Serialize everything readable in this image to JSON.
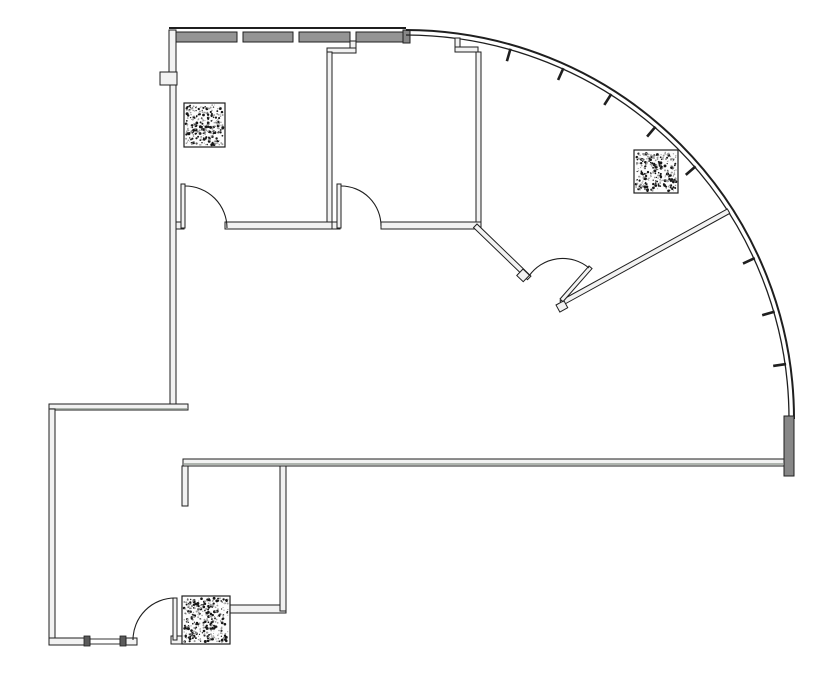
{
  "canvas": {
    "width": 835,
    "height": 678,
    "background": "#ffffff"
  },
  "colors": {
    "line": "#1f1f1f",
    "wall_fill": "#f2f2f2",
    "band_fill": "#949494",
    "heavy_fill": "#878787",
    "gray_line": "#98a098",
    "mullion": "#5a5a5a",
    "paper": "#ffffff"
  },
  "curved_wall": {
    "cx": 405,
    "cy": 419,
    "outer_r": 389,
    "inner_r": 384,
    "tick_angles_deg": [
      8.2,
      16.2,
      24.7,
      32.7,
      41.0,
      49.4,
      57.6,
      65.7,
      74.1
    ],
    "tick_len": 12
  },
  "columns": [
    {
      "id": "column-top-left",
      "x": 184,
      "y": 103,
      "w": 41,
      "h": 44
    },
    {
      "id": "column-right",
      "x": 634,
      "y": 150,
      "w": 44,
      "h": 43
    },
    {
      "id": "column-bottom-left",
      "x": 182,
      "y": 596,
      "w": 48,
      "h": 48
    }
  ],
  "stipple": {
    "seed": 42,
    "dark_color": "#161616",
    "light_color": "#9a9a9a"
  }
}
